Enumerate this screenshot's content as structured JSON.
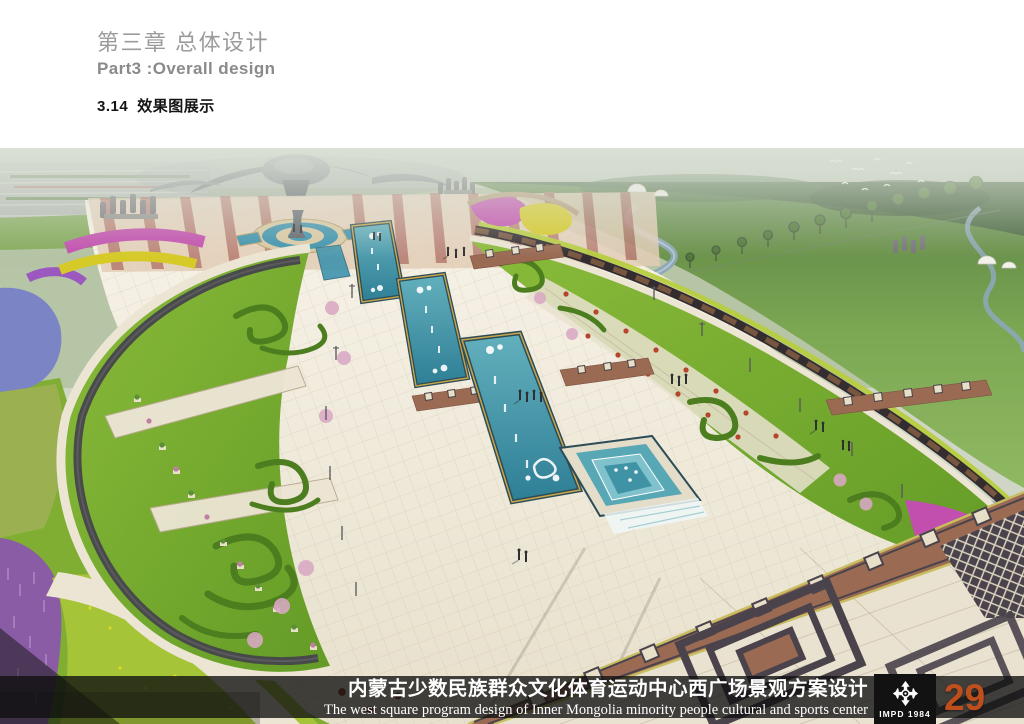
{
  "header": {
    "chapter_title_zh": "第三章 总体设计",
    "chapter_title_en": "Part3 :Overall design",
    "section_number": "3.14",
    "section_title": "效果图展示"
  },
  "rendering": {
    "alt": "Aerial perspective rendering of the west square: central axis with three teal Mongolian-pattern water pools and cascade fountain, two leaf-shaped topiary gardens, ornate meander paving, flower fields, grassland with winding river and cultural building"
  },
  "footer": {
    "project_title_zh": "内蒙古少数民族群众文化体育运动中心西广场景观方案设计",
    "project_title_en": "The west square program design of Inner Mongolia minority people cultural and sports center",
    "logo_text": "IMPD 1984",
    "page_number": "29"
  },
  "colors": {
    "header_text": "#9b9b9b",
    "section_text": "#141414",
    "footer_bar": "rgba(16,16,16,0.78)",
    "page_number": "#bf4e1d",
    "pool_teal": "#3f93a5",
    "lawn_green": "#7eb336",
    "paving_cream": "#efe9da",
    "meander_brown": "#9a6a52"
  }
}
